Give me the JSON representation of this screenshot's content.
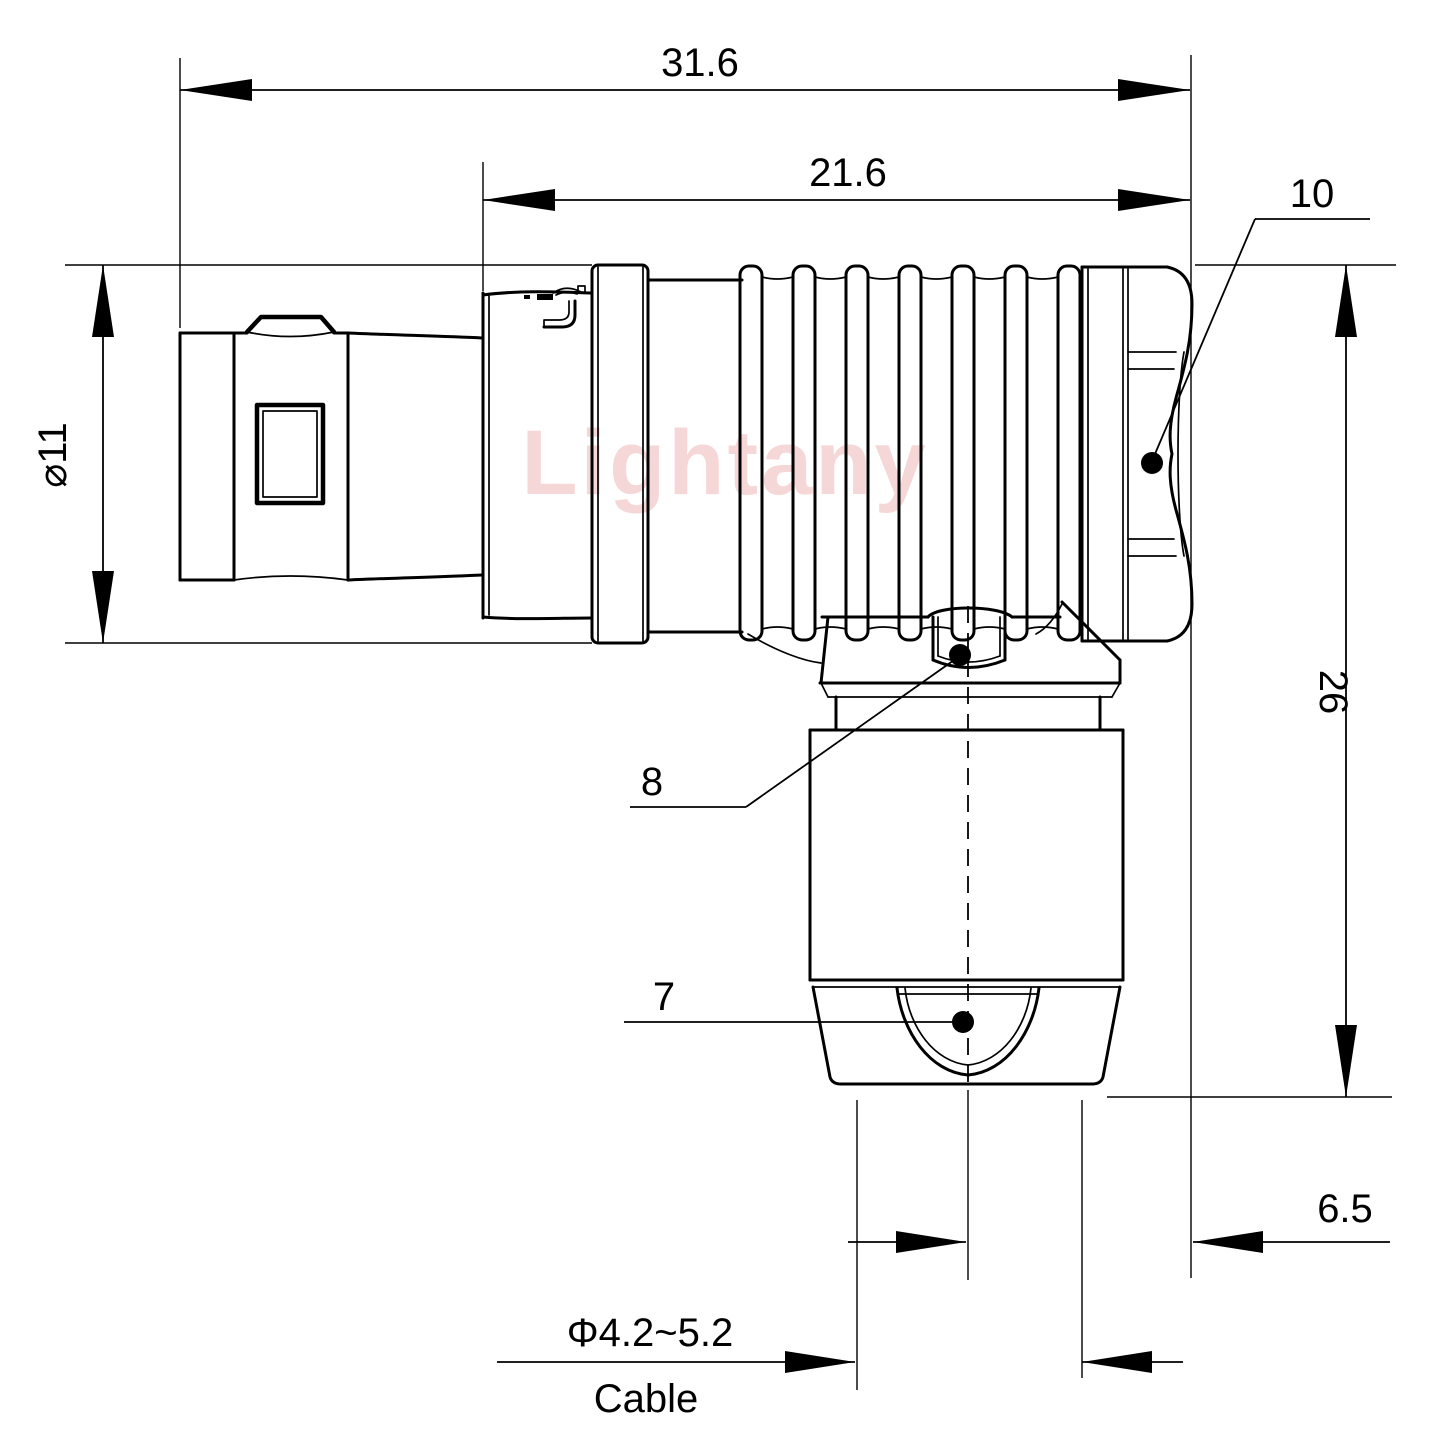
{
  "drawing": {
    "watermark": "Lightany",
    "dimensions": {
      "overall_length": "31.6",
      "front_length": "21.6",
      "shell_diameter": "⌀11",
      "elbow_height": "26",
      "axis_offset": "6.5",
      "cable_diameter": "Φ4.2~5.2",
      "cable_label": "Cable"
    },
    "balloons": {
      "coupling_nut": "10",
      "elbow_hex_nut": "8",
      "cable_bushing": "7"
    },
    "colors": {
      "line": "#000000",
      "watermark_pink": "#eeb0b0",
      "background": "#ffffff"
    }
  }
}
